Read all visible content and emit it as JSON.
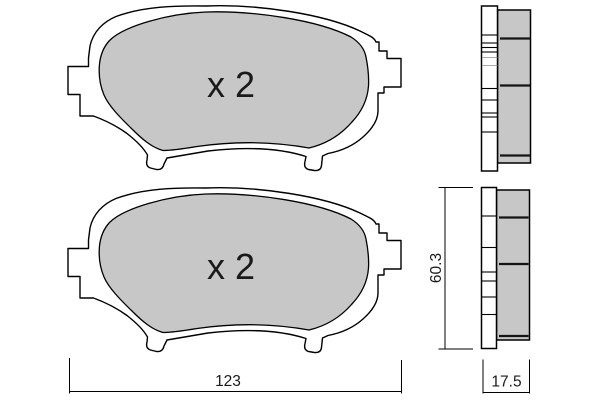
{
  "colors": {
    "background": "#ffffff",
    "pad_fill": "#c7c7c7",
    "outline": "#000000",
    "groove_line": "#141414",
    "light_section_line": "#a9a9a9"
  },
  "views": {
    "front_top": {
      "quantity_label": "x 2"
    },
    "front_bottom": {
      "quantity_label": "x 2"
    }
  },
  "dimensions": {
    "width_mm": "123",
    "height_mm": "60.3",
    "thickness_mm": "17.5"
  }
}
